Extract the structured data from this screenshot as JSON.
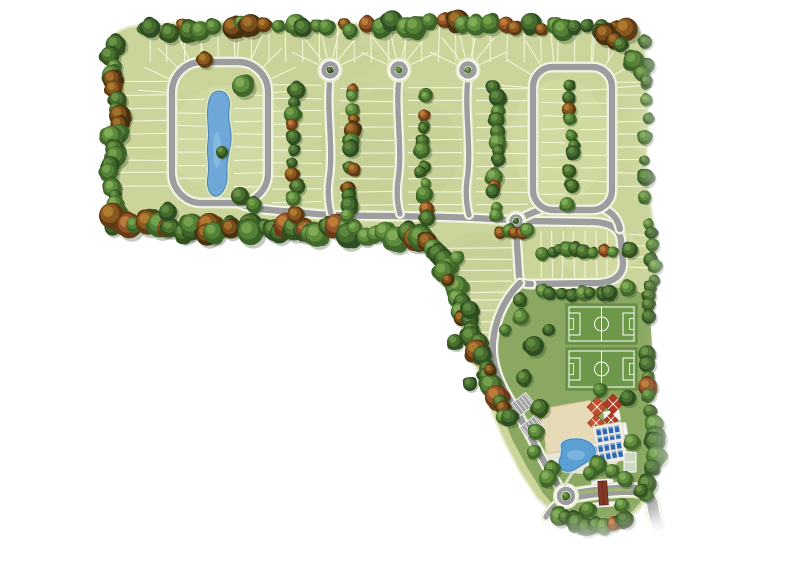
{
  "meta": {
    "description": "Aerial top-down site plan rendering of an L-shaped residential community: tree-lined lot blocks, one loop street around a central pond, three cul-de-sac streets, a second loop street, a corner block, two soccer fields, clubhouse amenity area with sand court, umbrellas, loungers and free-form pool, and a gated entrance boulevard with roundabout",
    "background": "#ffffff"
  },
  "palette": {
    "lot_grass": "#cbd59b",
    "lot_line": "#f5f8da",
    "lawn": "#8aa861",
    "road_asphalt": "#9d9d9d",
    "road_edge_line": "#ffffff",
    "road_verge": "#e8eecd",
    "island_green": "#aabf76",
    "pond_water": "#6fa8d8",
    "pond_shore": "#dceac2",
    "pool_water": "#5c9fd3",
    "pool_shore": "#bdd9ee",
    "sand": "#e7dab6",
    "deck": "#e7e6d6",
    "field_green": "#6d9749",
    "field_line": "#ffffff",
    "umbrella_red": "#c4502d",
    "umbrella_red2": "#b23a24",
    "lounger_blue": "#2f66b5",
    "lounger_pillow": "#7fa9dd",
    "gatehouse_roof": "#83392a",
    "parking_gray": "#a3a3a3",
    "median_green": "#9cb770",
    "tree_greens": [
      [
        "#33511f",
        "#4a7030",
        "#6c9446"
      ],
      [
        "#2f4d23",
        "#456b2f",
        "#5f8a3e"
      ],
      [
        "#3c6327",
        "#558037",
        "#76a14b"
      ],
      [
        "#44682c",
        "#5d8c3c",
        "#83ad58"
      ]
    ],
    "tree_autumns": [
      [
        "#5e3a14",
        "#8a581f",
        "#b07c31"
      ],
      [
        "#6b3a17",
        "#94552a",
        "#bf7f3a"
      ],
      [
        "#49310f",
        "#7a4d1c",
        "#a3712b"
      ]
    ]
  },
  "land": {
    "outline": "M 110 44 C 112 34 120 28 134 26 L 200 21 L 300 25 L 420 21 L 540 25 L 616 24 C 634 24 644 30 645 44 L 649 120 L 646 170 L 652 212 L 657 245 L 655 300 L 647 345 L 645 390 L 654 428 L 660 455 L 652 486 L 641 508 L 627 521 L 604 530 L 576 527 L 556 516 L 537 498 L 520 472 L 504 441 L 490 408 L 477 371 L 464 332 L 452 292 L 441 253 L 434 238 L 380 240 L 300 235 L 220 238 L 150 231 C 130 230 116 224 113 208 L 109 150 L 112 100 Z"
  },
  "lawn": {
    "outline": "M 522 288 L 600 287 C 622 287 640 290 649 297 L 652 346 L 646 392 L 654 433 L 659 459 L 649 491 L 633 511 L 610 524 L 585 526 L 561 514 L 543 493 L 527 467 L 512 439 L 501 412 L 494 384 L 493 352 C 494 327 505 303 522 288 Z"
  },
  "tint_patches": [
    {
      "cx": 230,
      "cy": 140,
      "rx": 60,
      "ry": 55,
      "color": "#dde6b0",
      "opacity": 0.3
    },
    {
      "cx": 390,
      "cy": 150,
      "rx": 70,
      "ry": 60,
      "color": "#bfcb8d",
      "opacity": 0.3
    },
    {
      "cx": 560,
      "cy": 140,
      "rx": 50,
      "ry": 60,
      "color": "#dde6b0",
      "opacity": 0.25
    },
    {
      "cx": 300,
      "cy": 58,
      "rx": 80,
      "ry": 28,
      "color": "#c3cf92",
      "opacity": 0.25
    },
    {
      "cx": 480,
      "cy": 262,
      "rx": 40,
      "ry": 30,
      "color": "#bfcb8d",
      "opacity": 0.3
    },
    {
      "cx": 600,
      "cy": 252,
      "rx": 40,
      "ry": 28,
      "color": "#dde6b0",
      "opacity": 0.3
    }
  ],
  "lot_strips": [
    {
      "dir": "h",
      "x1": 112,
      "x2": 170,
      "y1": 82,
      "y2": 198,
      "step": 13
    },
    {
      "dir": "h",
      "x1": 178,
      "x2": 205,
      "y1": 100,
      "y2": 188,
      "step": 13
    },
    {
      "dir": "h",
      "x1": 234,
      "x2": 265,
      "y1": 95,
      "y2": 190,
      "step": 13
    },
    {
      "dir": "h",
      "x1": 272,
      "x2": 322,
      "y1": 85,
      "y2": 205,
      "step": 13
    },
    {
      "dir": "h",
      "x1": 340,
      "x2": 394,
      "y1": 88,
      "y2": 206,
      "step": 13
    },
    {
      "dir": "h",
      "x1": 408,
      "x2": 462,
      "y1": 88,
      "y2": 206,
      "step": 13
    },
    {
      "dir": "h",
      "x1": 476,
      "x2": 528,
      "y1": 88,
      "y2": 206,
      "step": 13
    },
    {
      "dir": "h",
      "x1": 541,
      "x2": 565,
      "y1": 90,
      "y2": 200,
      "step": 13
    },
    {
      "dir": "h",
      "x1": 580,
      "x2": 607,
      "y1": 90,
      "y2": 200,
      "step": 13
    },
    {
      "dir": "h",
      "x1": 616,
      "x2": 646,
      "y1": 82,
      "y2": 198,
      "step": 13
    },
    {
      "dir": "h",
      "x1": 448,
      "x2": 512,
      "y1": 248,
      "y2": 292,
      "step": 11
    },
    {
      "dir": "h",
      "x1": 468,
      "x2": 518,
      "y1": 300,
      "y2": 338,
      "step": 11
    },
    {
      "dir": "h",
      "x1": 630,
      "x2": 648,
      "y1": 235,
      "y2": 278,
      "step": 11
    },
    {
      "dir": "v",
      "x1": 150,
      "x2": 628,
      "y1": 26,
      "y2": 62,
      "step": 17
    },
    {
      "dir": "v",
      "x1": 541,
      "x2": 616,
      "y1": 231,
      "y2": 278,
      "step": 11
    }
  ],
  "fans": [
    {
      "cx": 330,
      "cy": 70,
      "r1": 13,
      "r2": 42,
      "a1": -155,
      "a2": -25,
      "n": 6
    },
    {
      "cx": 399,
      "cy": 70,
      "r1": 13,
      "r2": 42,
      "a1": -155,
      "a2": -25,
      "n": 6
    },
    {
      "cx": 468,
      "cy": 70,
      "r1": 13,
      "r2": 42,
      "a1": -155,
      "a2": -25,
      "n": 6
    },
    {
      "cx": 206,
      "cy": 96,
      "r1": 30,
      "r2": 68,
      "a1": 185,
      "a2": 265,
      "n": 5
    },
    {
      "cx": 234,
      "cy": 96,
      "r1": 30,
      "r2": 68,
      "a1": 275,
      "a2": 355,
      "n": 5
    },
    {
      "cx": 556,
      "cy": 90,
      "r1": 24,
      "r2": 58,
      "a1": 185,
      "a2": 265,
      "n": 4
    },
    {
      "cx": 590,
      "cy": 90,
      "r1": 24,
      "r2": 58,
      "a1": 275,
      "a2": 355,
      "n": 4
    }
  ],
  "streets": {
    "loops": [
      {
        "x": 172,
        "y": 62,
        "w": 96,
        "h": 141,
        "rx": 30
      },
      {
        "x": 533,
        "y": 67,
        "w": 79,
        "h": 143,
        "rx": 20
      }
    ],
    "paths": [
      {
        "d": "M 234 202 C 258 212 284 210 306 213 C 350 218 430 214 508 220",
        "cls": "main"
      },
      {
        "d": "M 524 221 L 594 222 C 610 223 620 228 621 241 L 623 263 C 623 275 614 282 600 283 L 531 284",
        "cls": "main"
      },
      {
        "d": "M 516 228 L 519 276 C 520 283 524 284 531 284",
        "cls": "main"
      },
      {
        "d": "M 540 210 C 531 213 523 217 517 221",
        "cls": "main"
      },
      {
        "d": "M 606 210 C 614 214 618 220 620 229",
        "cls": "main"
      },
      {
        "d": "M 520 283 C 506 297 495 318 493 342 C 491 364 500 384 510 400 C 520 416 530 436 541 456 C 547 467 552 476 558 485",
        "cls": "main"
      },
      {
        "d": "M 330 78 C 326 110 334 150 329 180 C 327 195 329 206 331 214",
        "cls": "stem"
      },
      {
        "d": "M 399 78 C 395 110 403 150 398 180 C 396 196 398 207 400 214",
        "cls": "stem"
      },
      {
        "d": "M 468 78 C 464 110 472 150 467 180 C 465 196 467 207 469 215",
        "cls": "stem"
      },
      {
        "d": "M 576 495 C 600 491 620 489 634 490 C 646 491 652 498 653 507 C 654 514 656 521 659 527",
        "cls": "entry"
      },
      {
        "d": "M 557 504 C 552 508 549 512 546 517",
        "cls": "stem"
      }
    ],
    "culdesac_bulbs": [
      {
        "cx": 330,
        "cy": 70,
        "r": 9.5
      },
      {
        "cx": 399,
        "cy": 70,
        "r": 9.5
      },
      {
        "cx": 468,
        "cy": 70,
        "r": 9.5
      }
    ],
    "roundabouts": [
      {
        "cx": 516,
        "cy": 221,
        "r": 7.5
      },
      {
        "cx": 566,
        "cy": 496,
        "r": 10
      }
    ],
    "median": "M 580 493 C 598 490.5 616 489 630 490",
    "minor_paths": [
      "M 565 485 C 569 477 574 470 579 465",
      "M 543 430 C 550 438 554 447 556 455"
    ]
  },
  "pond": {
    "path": "M 219 91 C 227 91 231 99 229 110 C 227 120 232 128 231 140 C 230 152 226 160 227 171 C 228 183 224 194 217 196 C 210 197 206 188 208 176 C 210 164 206 154 208 142 C 210 130 206 118 208 106 C 209 97 212 91 219 91 Z",
    "highlight": {
      "cx": 217,
      "cy": 150,
      "rx": 4,
      "ry": 18
    }
  },
  "amenities": {
    "soccer_fields": [
      {
        "x": 566,
        "y": 304,
        "w": 71,
        "h": 40
      },
      {
        "x": 566,
        "y": 348,
        "w": 71,
        "h": 42
      }
    ],
    "deck": {
      "cx": 585,
      "cy": 447,
      "rx": 40,
      "ry": 27
    },
    "sand_court": {
      "cx": 569,
      "cy": 427,
      "w": 52,
      "h": 45,
      "rot": -10
    },
    "clubhouse": [
      {
        "cx": 612,
        "cy": 416,
        "w": 16,
        "h": 11,
        "rot": -10
      },
      {
        "cx": 617,
        "cy": 430,
        "w": 20,
        "h": 12,
        "rot": -10
      }
    ],
    "umbrellas": [
      {
        "cx": 597,
        "cy": 407,
        "r": 7
      },
      {
        "cx": 613,
        "cy": 404,
        "r": 7
      },
      {
        "cx": 596,
        "cy": 423,
        "r": 6
      },
      {
        "cx": 611,
        "cy": 420,
        "r": 5
      }
    ],
    "lounger_clusters": [
      {
        "cx": 609,
        "cy": 435,
        "rot": -10,
        "cols": 4,
        "rows": 2
      },
      {
        "cx": 608,
        "cy": 452,
        "rot": -10,
        "cols": 5,
        "rows": 2
      }
    ],
    "pool": {
      "path": "M 562 449 C 559 443 566 439 574 439 C 584 438 593 443 595 450 C 597 457 591 460 585 463 C 578 467 572 473 565 471 C 558 469 558 462 561 456 Z"
    },
    "sport_pad": {
      "x": 624,
      "y": 452,
      "w": 12,
      "h": 20
    },
    "parking": [
      {
        "cx": 518,
        "cy": 408,
        "w": 31,
        "h": 15,
        "rot": -38,
        "stalls": 7
      },
      {
        "cx": 531,
        "cy": 426,
        "w": 20,
        "h": 12,
        "rot": -38,
        "stalls": 4
      }
    ],
    "gatehouse": {
      "cx": 603,
      "cy": 492,
      "rot": -4
    }
  },
  "tree_belts": [
    {
      "pts": [
        [
          142,
          32
        ],
        [
          240,
          24
        ],
        [
          340,
          27
        ],
        [
          450,
          23
        ],
        [
          545,
          27
        ],
        [
          628,
          32
        ]
      ],
      "n": 40,
      "rmin": 6,
      "rmax": 12,
      "jx": 10,
      "jy": 9,
      "autumn": 0.3
    },
    {
      "pts": [
        [
          112,
          48
        ],
        [
          117,
          120
        ],
        [
          110,
          190
        ],
        [
          116,
          224
        ]
      ],
      "n": 22,
      "rmin": 6,
      "rmax": 11,
      "jx": 8,
      "jy": 8,
      "autumn": 0.25
    },
    {
      "pts": [
        [
          116,
          220
        ],
        [
          200,
          231
        ],
        [
          290,
          228
        ],
        [
          380,
          234
        ],
        [
          432,
          240
        ]
      ],
      "n": 44,
      "rmin": 7,
      "rmax": 13,
      "jx": 12,
      "jy": 11,
      "autumn": 0.3
    },
    {
      "pts": [
        [
          437,
          247
        ],
        [
          458,
          298
        ],
        [
          480,
          352
        ],
        [
          498,
          398
        ],
        [
          510,
          420
        ]
      ],
      "n": 26,
      "rmin": 7,
      "rmax": 12,
      "jx": 9,
      "jy": 8,
      "autumn": 0.15
    },
    {
      "pts": [
        [
          296,
          92
        ],
        [
          293,
          150
        ],
        [
          297,
          212
        ]
      ],
      "n": 11,
      "rmin": 5,
      "rmax": 9,
      "jx": 6,
      "jy": 10,
      "autumn": 0.3
    },
    {
      "pts": [
        [
          350,
          90
        ],
        [
          352,
          150
        ],
        [
          349,
          216
        ]
      ],
      "n": 13,
      "rmin": 5,
      "rmax": 9,
      "jx": 6,
      "jy": 10,
      "autumn": 0.25
    },
    {
      "pts": [
        [
          424,
          90
        ],
        [
          422,
          150
        ],
        [
          425,
          216
        ]
      ],
      "n": 13,
      "rmin": 5,
      "rmax": 9,
      "jx": 6,
      "jy": 10,
      "autumn": 0.25
    },
    {
      "pts": [
        [
          495,
          90
        ],
        [
          497,
          150
        ],
        [
          494,
          216
        ]
      ],
      "n": 13,
      "rmin": 5,
      "rmax": 9,
      "jx": 6,
      "jy": 10,
      "autumn": 0.25
    },
    {
      "pts": [
        [
          571,
          88
        ],
        [
          573,
          142
        ],
        [
          570,
          202
        ]
      ],
      "n": 11,
      "rmin": 5,
      "rmax": 9,
      "jx": 6,
      "jy": 9,
      "autumn": 0.15
    },
    {
      "pts": [
        [
          542,
          252
        ],
        [
          578,
          249
        ],
        [
          612,
          254
        ]
      ],
      "n": 9,
      "rmin": 5,
      "rmax": 8,
      "jx": 5,
      "jy": 4,
      "autumn": 0.2
    },
    {
      "pts": [
        [
          644,
          45
        ],
        [
          648,
          120
        ],
        [
          645,
          198
        ]
      ],
      "n": 9,
      "rmin": 5,
      "rmax": 9,
      "jx": 5,
      "jy": 9,
      "autumn": 0.1
    },
    {
      "pts": [
        [
          650,
          226
        ],
        [
          654,
          268
        ],
        [
          647,
          318
        ]
      ],
      "n": 10,
      "rmin": 5,
      "rmax": 9,
      "jx": 5,
      "jy": 7,
      "autumn": 0.15
    },
    {
      "pts": [
        [
          645,
          350
        ],
        [
          650,
          398
        ],
        [
          656,
          448
        ],
        [
          648,
          492
        ]
      ],
      "n": 13,
      "rmin": 6,
      "rmax": 11,
      "jx": 6,
      "jy": 8,
      "autumn": 0.08
    },
    {
      "pts": [
        [
          556,
          516
        ],
        [
          588,
          527
        ],
        [
          622,
          521
        ]
      ],
      "n": 9,
      "rmin": 6,
      "rmax": 10,
      "jx": 7,
      "jy": 5,
      "autumn": 0.1
    },
    {
      "pts": [
        [
          598,
          30
        ],
        [
          628,
          50
        ],
        [
          645,
          82
        ]
      ],
      "n": 8,
      "rmin": 6,
      "rmax": 11,
      "jx": 7,
      "jy": 7,
      "autumn": 0.15
    },
    {
      "pts": [
        [
          542,
          292
        ],
        [
          578,
          295
        ],
        [
          612,
          293
        ]
      ],
      "n": 8,
      "rmin": 5,
      "rmax": 8,
      "jx": 6,
      "jy": 4,
      "autumn": 0.2
    },
    {
      "pts": [
        [
          500,
          232
        ],
        [
          528,
          232
        ]
      ],
      "n": 5,
      "rmin": 5,
      "rmax": 8,
      "jx": 6,
      "jy": 5,
      "autumn": 0.2
    }
  ],
  "tree_singles": [
    [
      243,
      86,
      11,
      0
    ],
    [
      240,
      196,
      9,
      0
    ],
    [
      222,
      152,
      6,
      0
    ],
    [
      205,
      60,
      8,
      1
    ],
    [
      254,
      205,
      8,
      0
    ],
    [
      168,
      212,
      9,
      0
    ],
    [
      470,
      310,
      9,
      0
    ],
    [
      455,
      342,
      8,
      0
    ],
    [
      521,
      317,
      8,
      0
    ],
    [
      534,
      346,
      10,
      0
    ],
    [
      470,
      384,
      7,
      0
    ],
    [
      524,
      378,
      8,
      0
    ],
    [
      549,
      330,
      6,
      0
    ],
    [
      540,
      408,
      9,
      0
    ],
    [
      536,
      432,
      8,
      0
    ],
    [
      600,
      390,
      7,
      0
    ],
    [
      628,
      398,
      8,
      0
    ],
    [
      598,
      465,
      9,
      0
    ],
    [
      632,
      442,
      8,
      0
    ],
    [
      612,
      471,
      7,
      0
    ],
    [
      552,
      469,
      8,
      0
    ],
    [
      534,
      452,
      7,
      0
    ],
    [
      548,
      478,
      9,
      0
    ],
    [
      590,
      473,
      7,
      0
    ],
    [
      625,
      479,
      8,
      0
    ],
    [
      641,
      491,
      7,
      0
    ],
    [
      588,
      510,
      8,
      0
    ],
    [
      622,
      505,
      7,
      0
    ],
    [
      566,
      496,
      4,
      0
    ],
    [
      516,
      221,
      3,
      0
    ],
    [
      457,
      258,
      7,
      0
    ],
    [
      448,
      280,
      6,
      1
    ],
    [
      630,
      250,
      8,
      0
    ],
    [
      628,
      288,
      8,
      0
    ],
    [
      520,
      300,
      7,
      0
    ],
    [
      505,
      330,
      6,
      0
    ],
    [
      490,
      370,
      6,
      1
    ],
    [
      330,
      70,
      3.2,
      0
    ],
    [
      399,
      70,
      3.2,
      0
    ],
    [
      468,
      70,
      3.2,
      0
    ]
  ],
  "fades": [
    {
      "x": 640,
      "y": 514,
      "w": 120,
      "h": 50,
      "o": 0.95
    },
    {
      "x": 664,
      "y": 205,
      "w": 60,
      "h": 330,
      "o": 0.85
    },
    {
      "x": 430,
      "y": 532,
      "w": 270,
      "h": 40,
      "o": 0.92
    },
    {
      "x": 654,
      "y": 15,
      "w": 50,
      "h": 185,
      "o": 0.85
    }
  ]
}
